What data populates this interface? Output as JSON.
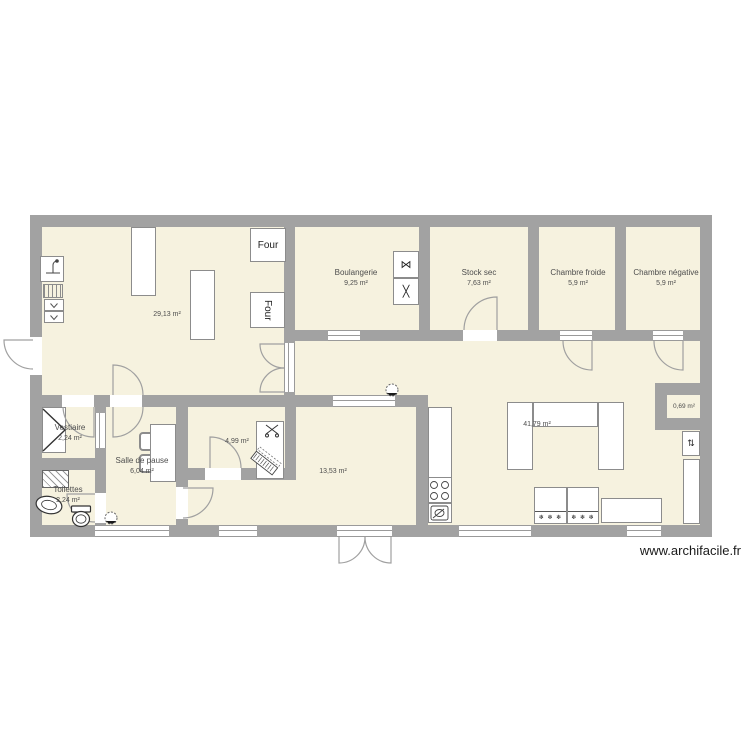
{
  "watermark": "www.archifacile.fr",
  "rooms": {
    "main_prep": {
      "area": "29,13 m²"
    },
    "boulangerie": {
      "name": "Boulangerie",
      "area": "9,25 m²"
    },
    "stock_sec": {
      "name": "Stock sec",
      "area": "7,63 m²"
    },
    "chambre_froide": {
      "name": "Chambre froide",
      "area": "5,9 m²"
    },
    "chambre_negative": {
      "name": "Chambre négative",
      "area": "5,9 m²"
    },
    "vestiaire": {
      "name": "Vestiaire",
      "area": "2,24 m²"
    },
    "salle_de_pause": {
      "name": "Salle de pause",
      "area": "6,04 m²"
    },
    "toilettes": {
      "name": "Toilettes",
      "area": "2,24 m²"
    },
    "bureau": {
      "area": "4,99 m²"
    },
    "labo": {
      "area": "13,53 m²"
    },
    "vente": {
      "area": "41,79 m²"
    },
    "placard": {
      "area": "0,69 m²"
    }
  },
  "equipment": {
    "oven_top": "Four",
    "oven_bottom": "Four"
  },
  "icons": {
    "snowflakes": "❄ ❄ ❄",
    "mixer_top": "⋈",
    "mixer_bottom": "╳",
    "arrows": "⇅"
  },
  "colors": {
    "floor": "#F6F2DF",
    "wall": "#A2A2A2",
    "furniture_border": "#8C8C8C",
    "text": "#4D4D4D",
    "watermark_text": "#1A1A1A"
  }
}
